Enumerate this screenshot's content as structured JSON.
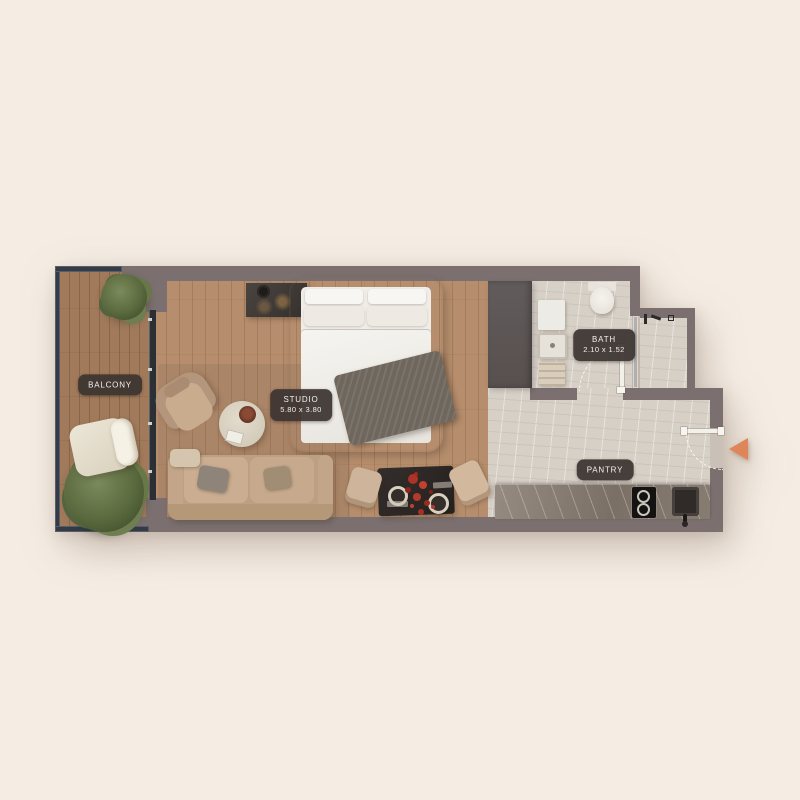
{
  "plan": {
    "type": "apartment-floor-plan",
    "rooms": {
      "balcony": {
        "label": "BALCONY"
      },
      "studio": {
        "label": "STUDIO",
        "dims": "5.80 x 3.80"
      },
      "bath": {
        "label": "BATH",
        "dims": "2.10 x 1.52"
      },
      "pantry": {
        "label": "PANTRY"
      }
    },
    "entrance": {
      "icon": "entrance-arrow-left"
    }
  },
  "colors": {
    "bg": "#f5ede4",
    "wall": "#7b706f",
    "wood_balcony": "#a07a5a",
    "wood_studio": "#b68e6d",
    "tile": "#d7d0c7",
    "tile_dark": "#c9c1b8",
    "counter": "#8a7e74",
    "wardrobe": "#5d5657",
    "glass": "#343b46",
    "label_text": "#f4f1ed",
    "arrow": "#de8659"
  }
}
